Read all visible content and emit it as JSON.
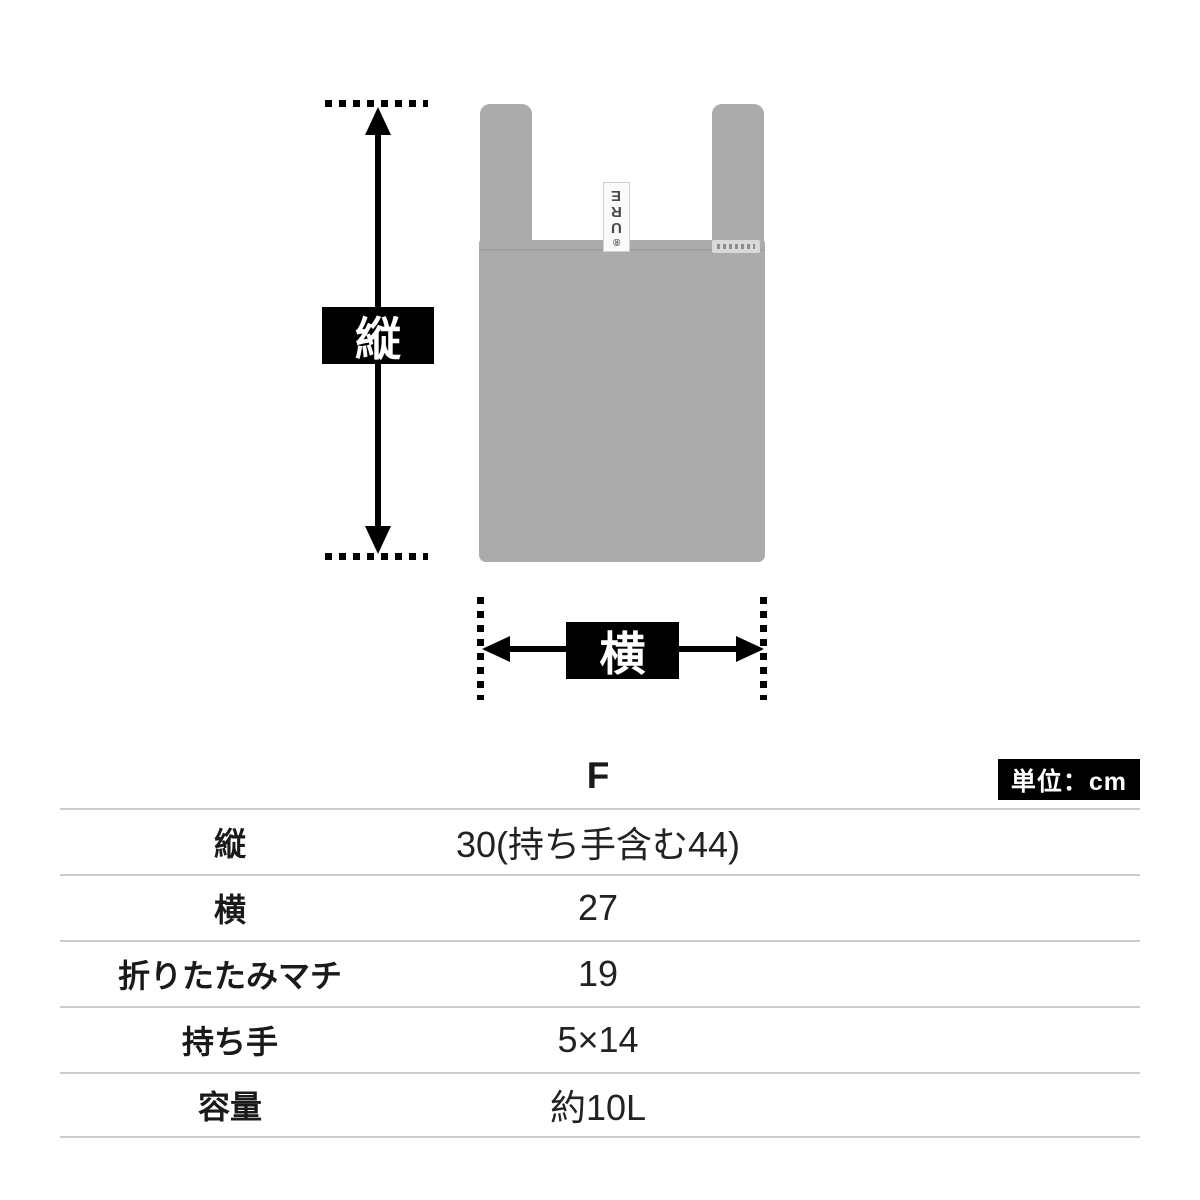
{
  "diagram": {
    "vertical_dimension_label": "縦",
    "horizontal_dimension_label": "横",
    "bag": {
      "color": "#ababab",
      "tag_letters": [
        "E",
        "R",
        "U",
        "®"
      ]
    }
  },
  "table": {
    "size_column_header": "F",
    "unit_badge": "単位：cm",
    "rows": [
      {
        "label": "縦",
        "value": "30(持ち手含む44)"
      },
      {
        "label": "横",
        "value": "27"
      },
      {
        "label": "折りたたみマチ",
        "value": "19"
      },
      {
        "label": "持ち手",
        "value": "5×14"
      },
      {
        "label": "容量",
        "value": "約10L"
      }
    ]
  },
  "colors": {
    "bag_gray": "#ababab",
    "indicator_black": "#000000",
    "table_line_gray": "#cccccc",
    "background": "#ffffff"
  }
}
